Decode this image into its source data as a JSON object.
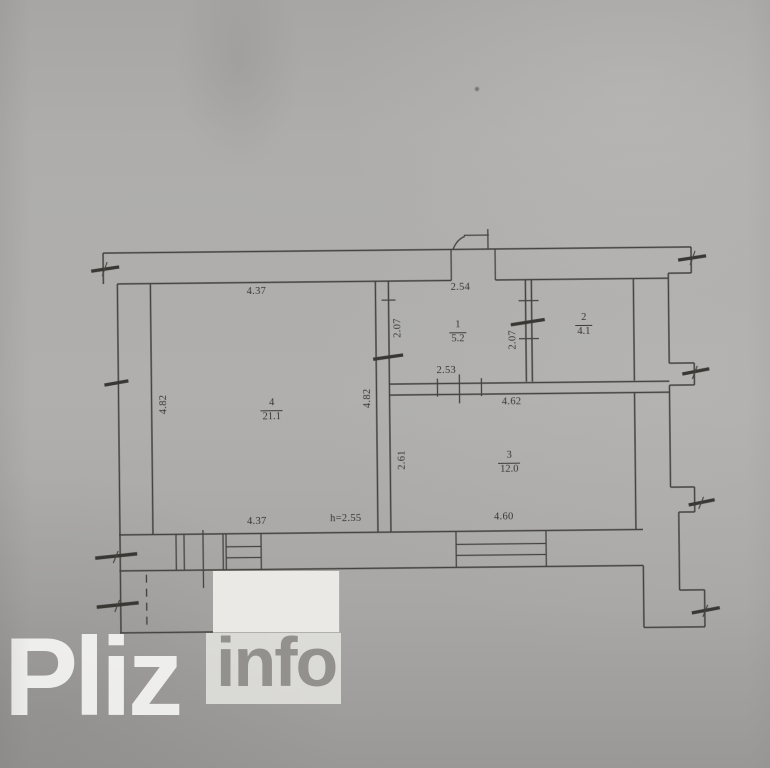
{
  "watermark": {
    "brand": "Pliz",
    "suffix": "info"
  },
  "plan": {
    "rooms": [
      {
        "number": "4",
        "area": "21.1"
      },
      {
        "number": "1",
        "area": "5.2"
      },
      {
        "number": "2",
        "area": "4.1"
      },
      {
        "number": "3",
        "area": "12.0"
      }
    ],
    "dimensions": [
      {
        "text": "4.37",
        "placement": "room4-top"
      },
      {
        "text": "2.54",
        "placement": "room1-top"
      },
      {
        "text": "2.07",
        "placement": "room1-left"
      },
      {
        "text": "2.07",
        "placement": "room1-right"
      },
      {
        "text": "4.82",
        "placement": "room4-left"
      },
      {
        "text": "4.82",
        "placement": "room4-right"
      },
      {
        "text": "2.53",
        "placement": "room1-bottom"
      },
      {
        "text": "4.62",
        "placement": "room3-top"
      },
      {
        "text": "2.61",
        "placement": "room3-left"
      },
      {
        "text": "4.60",
        "placement": "room3-bottom"
      },
      {
        "text": "4.37",
        "placement": "room4-bottom"
      },
      {
        "text": "h=2.55",
        "placement": "ceiling-height"
      }
    ]
  }
}
